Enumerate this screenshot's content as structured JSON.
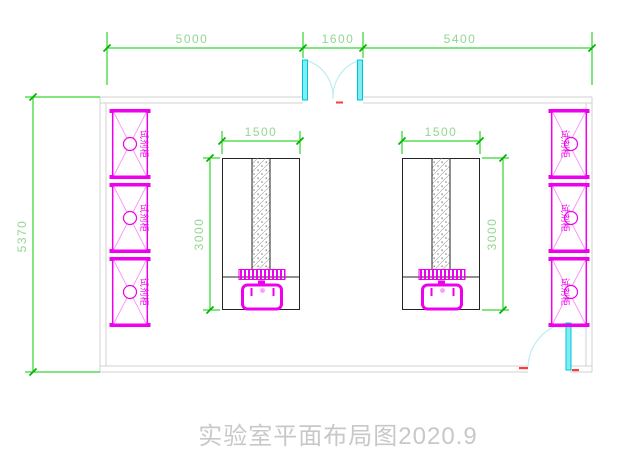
{
  "drawing": {
    "title": "实验室平面布局图2020.9",
    "dimensions": {
      "top_left": "5000",
      "top_middle": "1600",
      "top_right": "5400",
      "wall_left": "5370",
      "bench_left_width": "1500",
      "bench_right_width": "1500",
      "bench_left_height": "3000",
      "bench_right_height": "3000"
    },
    "cabinet_label": "试剂柜",
    "colors": {
      "dimension_line": "#00cc00",
      "dimension_text": "#93d693",
      "wall": "#d2d2d2",
      "cabinet": "#ee00ee",
      "door": "#00c4d6",
      "bench": "#232323",
      "red_mark": "#ff3a3a",
      "title_text": "#c8c8c8",
      "background": "#ffffff"
    }
  }
}
